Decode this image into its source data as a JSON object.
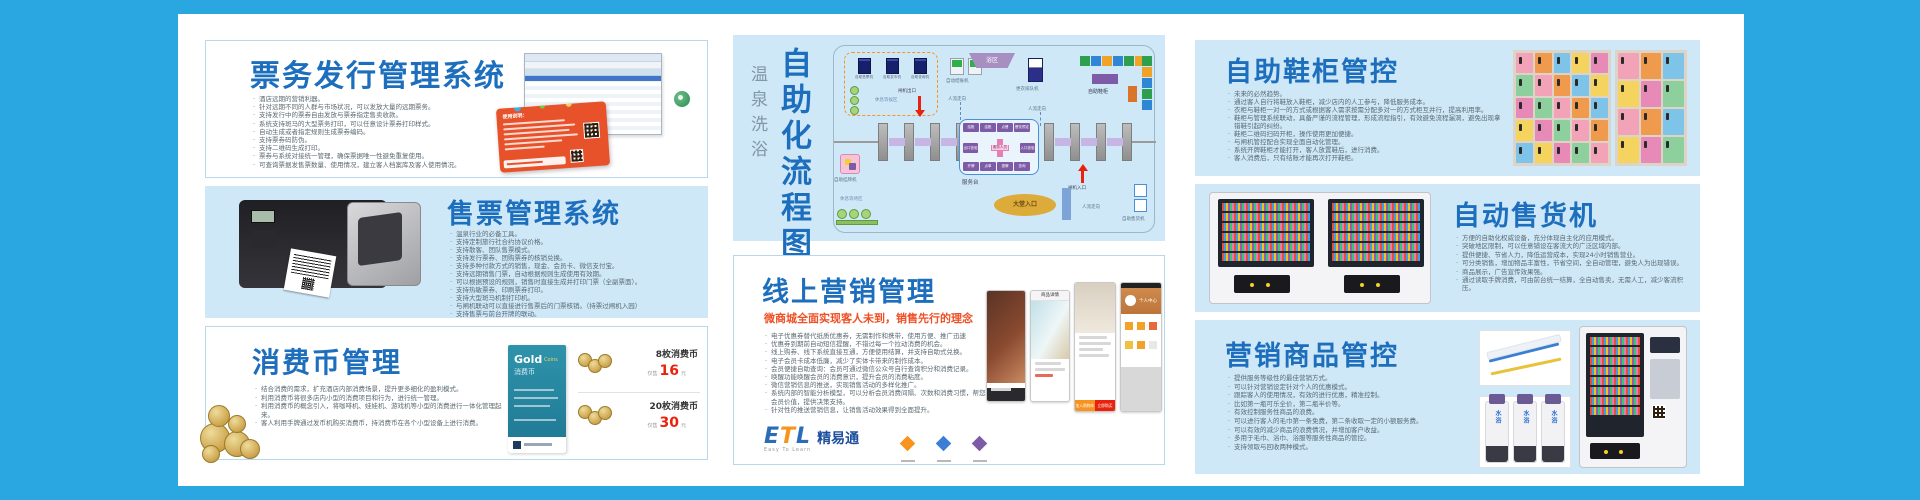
{
  "colors": {
    "frame_blue": "#2aa7e0",
    "panel_blue": "#cfe8f8",
    "title_blue": "#1d6fbd",
    "subtitle_red": "#f04e23",
    "price_red": "#e8220d"
  },
  "panels": {
    "ticket_issue": {
      "title": "票务发行管理系统",
      "card_heading": "使用说明：",
      "bullets": [
        "酒店远期的营销利器。",
        "针对远期不同的人群与市场状况，可以发放大量的远期票务。",
        "支持发行中的票券自由发放与票券指定售卖收款。",
        "系统支持斑马的大型票务打印，可以任意设计票券打印样式。",
        "自动生成或者指定规则生成票券编码。",
        "支持票券码防伪。",
        "支持二维码生成打印。",
        "票券与系统对接统一管理，确保票据唯一性避免重复使用。",
        "可查询票据发售票数量、使用情况，建立客人档案库及客人使用情况。"
      ]
    },
    "ticket_sale": {
      "title": "售票管理系统",
      "bullets": [
        "温泉行业的必备工具。",
        "支持定制旅行社合约协议价格。",
        "支持散客、团队售票模式。",
        "支持发行票券、团购票券的核销兑换。",
        "支持多种付款方式的销售，现金、会员卡、微信支付宝。",
        "支持远期销售门票，自动根据规则生成使用有效期。",
        "可以根据预设的规则，销售时直接生成并打印门票（全副票面）。",
        "支持热敏票券、印刷票券打印。",
        "支持大型斑马机制打印机。",
        "与闸机联动可以直接进行售票后的门票核销。（持票过闸机入园）",
        "支持售票与前台开牌的联动。"
      ]
    },
    "coins": {
      "title": "消费币管理",
      "bullets": [
        "结合消费的需求，扩充酒店内部消费场景，提升更多细化的盈利模式。",
        "利用消费币将很多店内小型的消费项目和行为，进行统一管理。",
        "利用消费币的概念引入，将咖啡机、娃娃机、游戏机等小型的消费进行一体化管理起来。",
        "客人利用手牌通过发币机购买消费币，持消费币在各个小型设备上进行消费。"
      ],
      "card": {
        "brand": "Gold",
        "brand2": "Coins",
        "label": "消费币"
      },
      "offers": [
        {
          "name": "8枚消费币",
          "prefix": "仅售",
          "price": "16",
          "unit": "元"
        },
        {
          "name": "20枚消费币",
          "prefix": "仅售",
          "price": "30",
          "unit": "元"
        }
      ]
    },
    "flow": {
      "title": "自助化流程图",
      "subtitle": "温泉洗浴",
      "labels": {
        "machines": [
          "自助售票机",
          "自助发币机",
          "自助查询机"
        ],
        "rest_top": "休息等候区",
        "checkout": "自动结账机",
        "bath": "浴区",
        "queue": "更衣排队机",
        "shoe": "自助鞋柜",
        "flow_dir": "人流走向",
        "gate_out": "闸机出口",
        "gate_in": "闸机入口",
        "desk": "服务台",
        "staff": "服务人员",
        "lobby": "大堂入口",
        "rest_bottom": "休息等待区",
        "vending": "自助售货机",
        "tag_machine": "自助挂牌机",
        "desk_chips_top": [
          "结账",
          "结账",
          "点餐",
          "餐饮预定"
        ],
        "desk_chip_left": "出口查验",
        "desk_chip_right": "入口查验",
        "desk_chips_bottom": [
          "开牌",
          "点单",
          "退牌",
          "查询"
        ]
      }
    },
    "online": {
      "title": "线上营销管理",
      "subtitle": "微商城全面实现客人未到，销售先行的理念",
      "bullets": [
        "电子优惠券替代纸质优惠券，无需制作和携带，使用方便、推广迅速",
        "优惠券到期前自动短信提醒，不错过每一个拉动消费的机会。",
        "线上购券、线下系统直接互通，方便使用结算，并支持自助式兑换。",
        "电子会员卡成本低廉，减少了实体卡带来的制作成本。",
        "会员便捷自助查询：会员可通过微信公众号自行查询积分和消费记录。",
        "唤醒功能唤醒会员的消费意识，提升会员的消费粘度。",
        "微信营销信息的推送，实现销售活动的多样化推广。",
        "系统内部的智能分析模型，可以分析会员消费间隔、次数和消费习惯，帮您精准判断会员价值，提供决策支持。",
        "针对性的推送营销信息，让销售活动效果得到全面提升。"
      ],
      "logo": {
        "mark_e": "E",
        "mark_t": "T",
        "mark_l": "L",
        "name": "精易通",
        "tagline": "Easy To Learn"
      },
      "phones": {
        "p2_header": "商品详情",
        "p4_header": "个人中心",
        "cart": "加入购物车",
        "buy": "立即购买"
      }
    },
    "shoe": {
      "title": "自助鞋柜管控",
      "bullets": [
        "未来的必然趋势。",
        "通过客人自行将鞋放入鞋柜，减少店内的人工参与，降低服务成本。",
        "衣柜与鞋柜一对一的方式或根据客人需求按需分配多对一的方式柜互并行，提高利用率。",
        "鞋柜与管理系统联动，具备严谨的流程管理，形成流程指引，有效避免流程漏洞，避免出现拿错鞋引起的纠纷。",
        "鞋柜二维码扫码开柜，操作使用更加便捷。",
        "与闸机管控配合实现全面自动化管理。",
        "系统开牌鞋柜才能打开，客人放置鞋后，进行消费。",
        "客人消费后，只有结账才能再次打开鞋柜。"
      ]
    },
    "vending": {
      "title": "自动售货机",
      "bullets": [
        "方便的自助化权威设备，充分体现自主化的应用模式。",
        "突破地区限制，可以任意铺设在客流大的广泛区域内部。",
        "提供便捷、节省人力，降低运营成本，实现24小时销售营业。",
        "可分类销售，增加物品丰富性，节省空间，全自动管理，避免人为出现错误。",
        "商品展示，广告宣传效果强。",
        "通过读取手牌消费，可由前台统一结算，全自动售卖，无需人工，减少客流积压。"
      ]
    },
    "goods": {
      "title": "营销商品管控",
      "bottle_label": "水浴",
      "bullets": [
        "提供服务等级性的最佳营销方式。",
        "可以针对营销设定针对个人的优惠模式。",
        "跟踪客人的使用情况，有效的进行优惠，精准控制。",
        "比如第一瓶可乐全价，第二瓶半价等。",
        "有效控制服务性商品的浪费。",
        "可以进行客人的毛巾第一条免费，第二条收取一定的小额服务费。",
        "可以有效的减少商品的浪费情况，并增加客户收益。",
        "多用于毛巾、浴巾、浴服等服务性商品的管控。",
        "支持领取与回收两种模式。"
      ]
    }
  }
}
